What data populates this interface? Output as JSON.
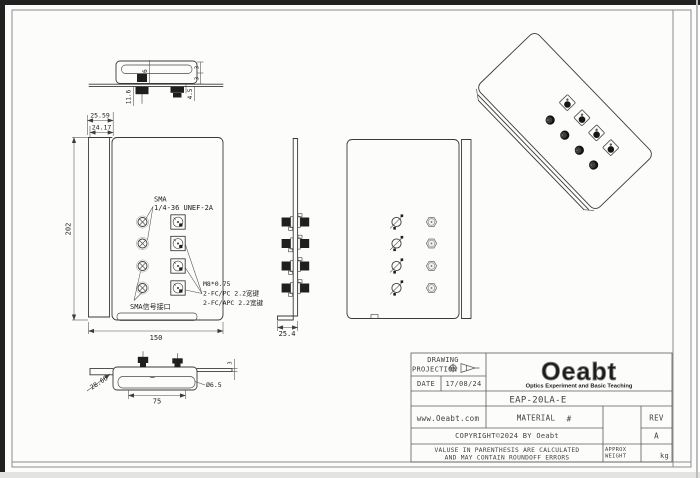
{
  "annotations": {
    "sma_label": "SMA",
    "sma_thread": "1/4-36 UNEF-2A",
    "fc_thread": "M8*0.75",
    "fc_pc": "2-FC/PC 2.2宽键",
    "fc_apc": "2-FC/APC 2.2宽键",
    "sma_port": "SMA信号接口"
  },
  "dimensions": {
    "top_view": {
      "d_11_6": "11.6",
      "d_6": "6",
      "d_5": "5",
      "d_4_5": "4.5",
      "d_3a": "3",
      "d_3b": "3"
    },
    "front_view": {
      "d_25_59": "25.59",
      "d_24_17": "24.17",
      "d_202": "202",
      "d_150": "150"
    },
    "side_view": {
      "d_25_4": "25.4"
    },
    "bottom_view": {
      "d_28_66": "28.66",
      "d_75": "75",
      "d_dia": "Ø6.5",
      "d_3": "3"
    }
  },
  "title_block": {
    "drawing_label": "DRAWING",
    "projection_label": "PROJECTION",
    "date_label": "DATE",
    "date_value": "17/08/24",
    "logo_text": "Oeabt",
    "logo_subtitle": "Optics Experiment and Basic Teaching",
    "part_number": "EAP-20LA-E",
    "website": "www.Oeabt.com",
    "material_label": "MATERIAL",
    "material_value": "#",
    "rev_label": "REV",
    "rev_value": "A",
    "copyright": "COPYRIGHT©2024 BY Oeabt",
    "disclaimer_line1": "VALUSE IN PARENTHESIS ARE CALCULATED",
    "disclaimer_line2": "AND MAY CONTAIN ROUNDOFF ERRORS",
    "approx_label": "APPROX",
    "weight_label": "WEIGHT",
    "weight_unit": "kg"
  },
  "colors": {
    "line": "#3a3a3a",
    "sheet": "#fcfcfa"
  }
}
